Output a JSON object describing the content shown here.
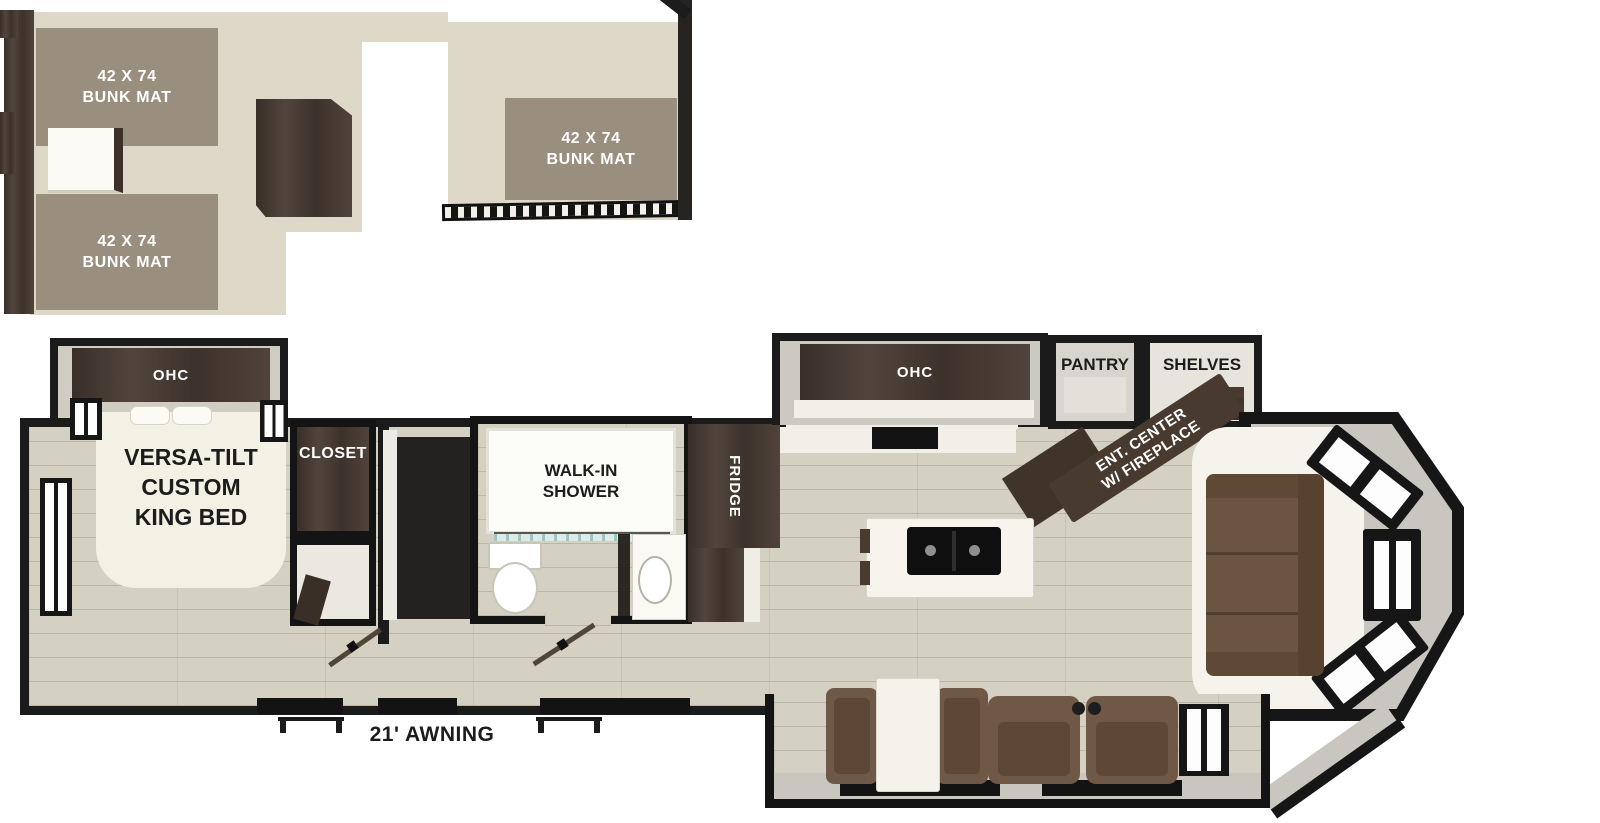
{
  "loft": {
    "bunk_mats": [
      {
        "line1": "42 X 74",
        "line2": "BUNK MAT"
      },
      {
        "line1": "42 X 74",
        "line2": "BUNK MAT"
      },
      {
        "line1": "42 X 74",
        "line2": "BUNK MAT"
      }
    ]
  },
  "bedroom": {
    "ohc_label": "OHC",
    "bed_label_lines": [
      "VERSA-TILT",
      "CUSTOM",
      "KING BED"
    ],
    "closet_label": "CLOSET"
  },
  "bathroom": {
    "shower_label_lines": [
      "WALK-IN",
      "SHOWER"
    ]
  },
  "kitchen": {
    "fridge_label": "FRIDGE",
    "ohc_label": "OHC",
    "pantry_label": "PANTRY",
    "shelves_label": "SHELVES",
    "ent_center_label_lines": [
      "ENT. CENTER",
      "W/ FIREPLACE"
    ]
  },
  "exterior": {
    "awning_label": "21' AWNING"
  },
  "colors": {
    "wall": "#1b1b1b",
    "main_floor": "#d5d1c2",
    "loft_floor": "#ddd8c8",
    "bunk_mat": "#9a8f7e",
    "dark_wood": "#463931",
    "sofa_brown": "#6b5440",
    "white_surface": "#f5f3ec",
    "slide_gray": "#c9c6bf"
  }
}
